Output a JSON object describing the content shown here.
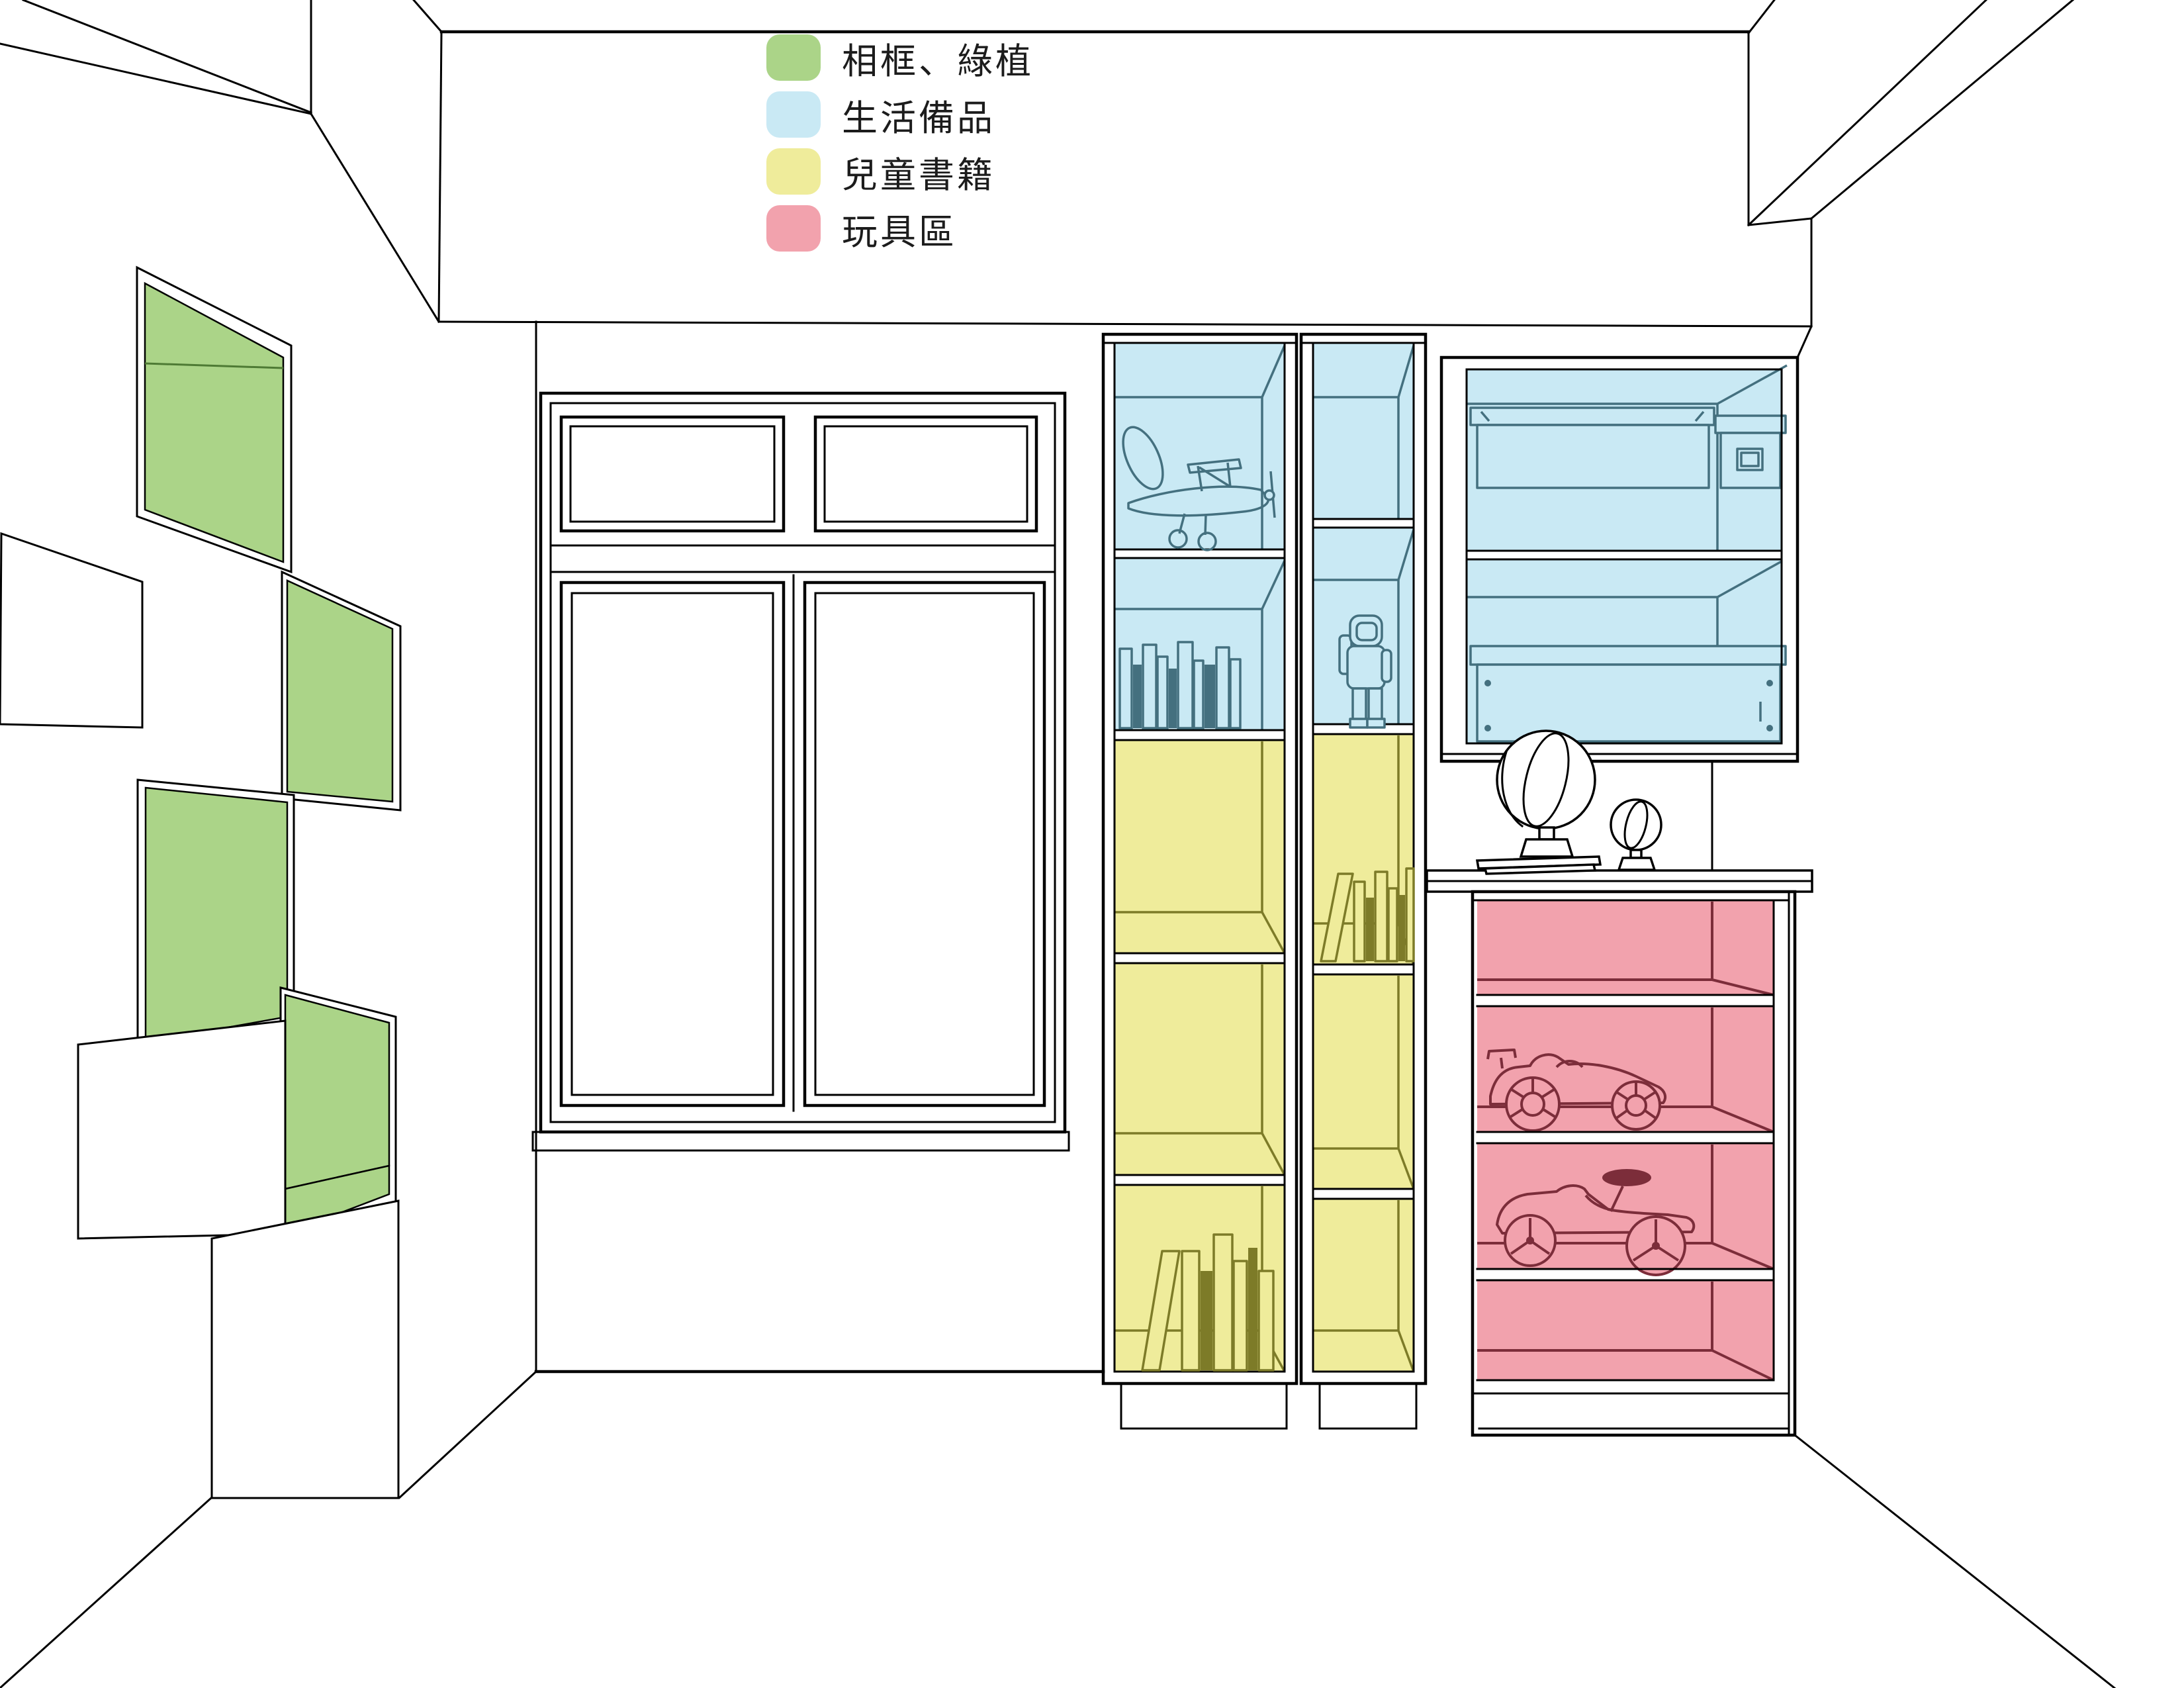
{
  "legend": {
    "items": [
      {
        "label": "相框、綠植",
        "color": "#abd488"
      },
      {
        "label": "生活備品",
        "color": "#c9e9f4"
      },
      {
        "label": "兒童書籍",
        "color": "#efec9b"
      },
      {
        "label": "玩具區",
        "color": "#f2a2ad"
      }
    ]
  },
  "colors": {
    "green": "#abd488",
    "greenLine": "#4e7a34",
    "blue": "#c9e9f4",
    "blueLine": "#44707f",
    "yellow": "#efec9b",
    "yellowLine": "#7d7b28",
    "pink": "#f2a2ad",
    "pinkLine": "#7c2d3a",
    "line": "#000000"
  }
}
